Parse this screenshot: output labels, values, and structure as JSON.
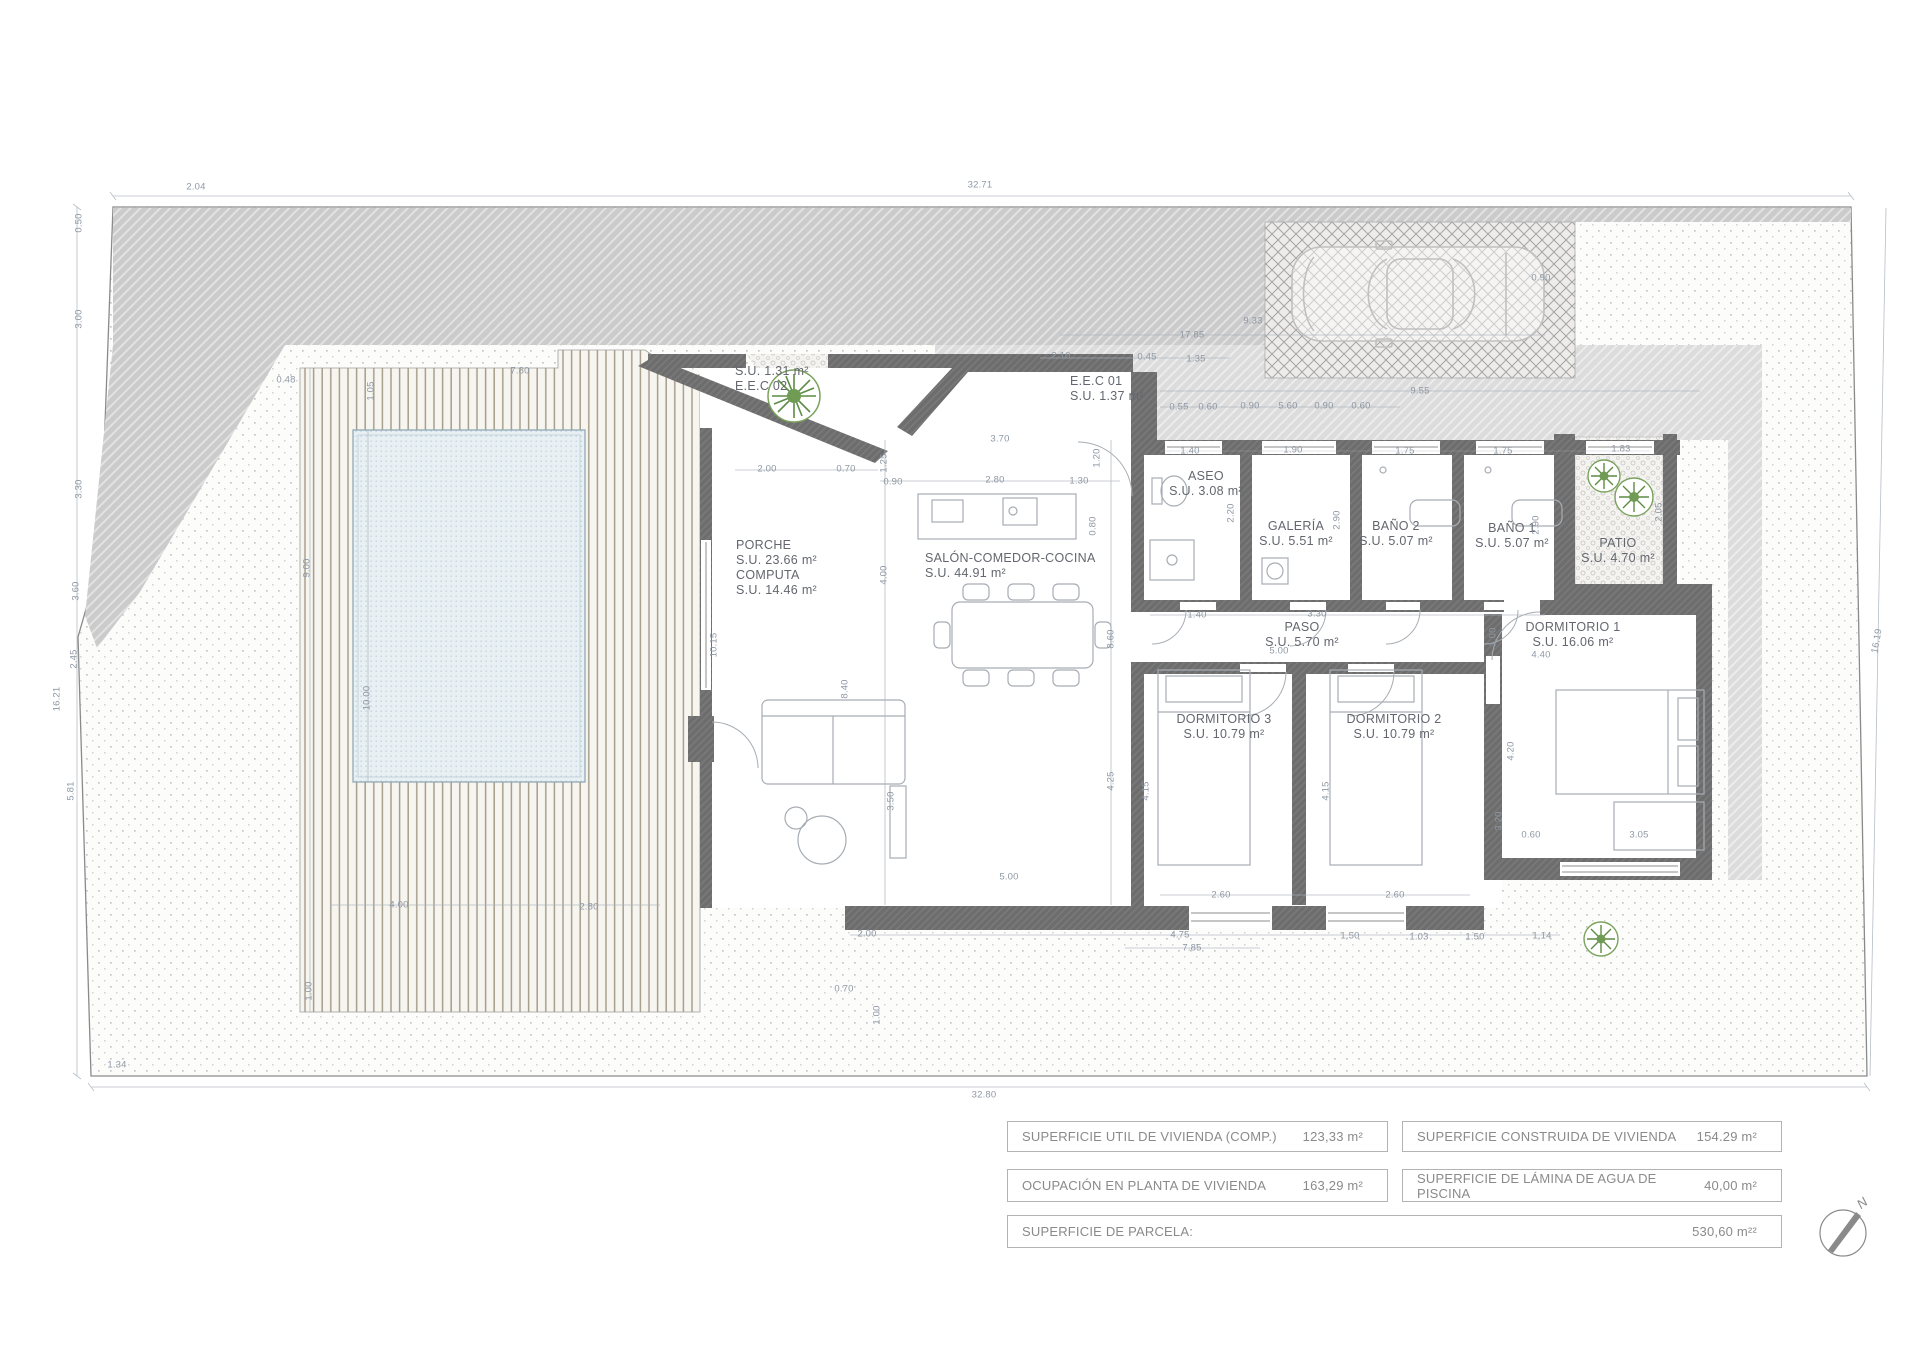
{
  "colors": {
    "wall_gray": "#6d6d6d",
    "pool_blue": "#e9f0f4",
    "plant_green": "#6f9b55",
    "dim_text": "#8e98a4",
    "hatch_gray": "#cbcbcb"
  },
  "compass": {
    "north": "N"
  },
  "plan": {
    "rooms": [
      {
        "l1": "PORCHE",
        "l2": "S.U. 23.66 m²",
        "x": 736,
        "y": 538,
        "a": "l"
      },
      {
        "l1": "COMPUTA",
        "l2": "S.U. 14.46 m²",
        "x": 736,
        "y": 568,
        "a": "l"
      },
      {
        "l1": "SALÓN-COMEDOR-COCINA",
        "l2": "S.U. 44.91 m²",
        "x": 925,
        "y": 551,
        "a": "l"
      },
      {
        "l1": "E.E.C 01",
        "l2": "S.U. 1.37 m²",
        "x": 1070,
        "y": 374,
        "a": "l"
      },
      {
        "l1": "S.U. 1.31 m²",
        "l2": "E.E.C 02",
        "x": 735,
        "y": 364,
        "a": "l"
      },
      {
        "l1": "ASEO",
        "l2": "S.U. 3.08 m²",
        "x": 1206,
        "y": 469,
        "a": "c"
      },
      {
        "l1": "GALERÍA",
        "l2": "S.U. 5.51 m²",
        "x": 1296,
        "y": 519,
        "a": "c"
      },
      {
        "l1": "BAÑO 2",
        "l2": "S.U. 5.07 m²",
        "x": 1396,
        "y": 519,
        "a": "c"
      },
      {
        "l1": "BAÑO 1",
        "l2": "S.U. 5.07 m²",
        "x": 1512,
        "y": 521,
        "a": "c"
      },
      {
        "l1": "PATIO",
        "l2": "S.U. 4.70 m²",
        "x": 1618,
        "y": 536,
        "a": "c"
      },
      {
        "l1": "PASO",
        "l2": "S.U. 5.70 m²",
        "x": 1302,
        "y": 620,
        "a": "c"
      },
      {
        "l1": "DORMITORIO 1",
        "l2": "S.U. 16.06 m²",
        "x": 1573,
        "y": 620,
        "a": "c"
      },
      {
        "l1": "DORMITORIO 3",
        "l2": "S.U. 10.79 m²",
        "x": 1224,
        "y": 712,
        "a": "c"
      },
      {
        "l1": "DORMITORIO 2",
        "l2": "S.U. 10.79 m²",
        "x": 1394,
        "y": 712,
        "a": "c"
      }
    ],
    "dims": [
      [
        "32.71",
        980,
        185,
        0
      ],
      [
        "2.04",
        196,
        187,
        0
      ],
      [
        "0.90",
        1541,
        278,
        0
      ],
      [
        "9.33",
        1253,
        321,
        0
      ],
      [
        "17.85",
        1192,
        335,
        0
      ],
      [
        "2.10",
        1061,
        356,
        0
      ],
      [
        "0.45",
        1147,
        357,
        0
      ],
      [
        "1.35",
        1196,
        359,
        0
      ],
      [
        "9.55",
        1420,
        391,
        0
      ],
      [
        "0.55",
        1179,
        407,
        0
      ],
      [
        "0.60",
        1208,
        407,
        0
      ],
      [
        "0.90",
        1250,
        406,
        0
      ],
      [
        "5.60",
        1288,
        406,
        0
      ],
      [
        "0.90",
        1324,
        406,
        0
      ],
      [
        "0.60",
        1361,
        406,
        0
      ],
      [
        "7.80",
        520,
        371,
        0
      ],
      [
        "0.48",
        286,
        380,
        0
      ],
      [
        "1.05",
        371,
        391,
        -90
      ],
      [
        "9.00",
        307,
        568,
        -90
      ],
      [
        "10.00",
        367,
        698,
        -90
      ],
      [
        "2.00",
        767,
        469,
        0
      ],
      [
        "0.70",
        846,
        469,
        0
      ],
      [
        "3.70",
        1000,
        439,
        0
      ],
      [
        "1.25",
        884,
        463,
        -90
      ],
      [
        "0.90",
        893,
        482,
        0
      ],
      [
        "2.80",
        995,
        480,
        0
      ],
      [
        "1.30",
        1079,
        481,
        0
      ],
      [
        "1.20",
        1097,
        458,
        -90
      ],
      [
        "0.80",
        1093,
        526,
        -90
      ],
      [
        "4.00",
        884,
        575,
        -90
      ],
      [
        "10.15",
        714,
        645,
        -90
      ],
      [
        "8.40",
        845,
        689,
        -90
      ],
      [
        "8.60",
        1111,
        639,
        -90
      ],
      [
        "3.50",
        891,
        801,
        -90
      ],
      [
        "4.25",
        1111,
        781,
        -90
      ],
      [
        "1.40",
        1190,
        451,
        0
      ],
      [
        "1.90",
        1293,
        450,
        0
      ],
      [
        "1.75",
        1405,
        451,
        0
      ],
      [
        "1.75",
        1503,
        451,
        0
      ],
      [
        "1.83",
        1621,
        449,
        0
      ],
      [
        "2.20",
        1231,
        513,
        -90
      ],
      [
        "2.90",
        1337,
        520,
        -90
      ],
      [
        "2.90",
        1536,
        525,
        -90
      ],
      [
        "2.05",
        1659,
        512,
        -90
      ],
      [
        "1.40",
        1197,
        615,
        0
      ],
      [
        "3.30",
        1317,
        614,
        0
      ],
      [
        "5.00",
        1279,
        651,
        0
      ],
      [
        "1.00",
        1493,
        637,
        -90
      ],
      [
        "4.40",
        1541,
        655,
        0
      ],
      [
        "4.15",
        1146,
        791,
        -90
      ],
      [
        "4.15",
        1326,
        791,
        -90
      ],
      [
        "4.20",
        1511,
        751,
        -90
      ],
      [
        "3.20",
        1499,
        821,
        -90
      ],
      [
        "0.60",
        1531,
        835,
        0
      ],
      [
        "3.05",
        1639,
        835,
        0
      ],
      [
        "2.60",
        1221,
        895,
        0
      ],
      [
        "2.60",
        1395,
        895,
        0
      ],
      [
        "5.00",
        1009,
        877,
        0
      ],
      [
        "4.00",
        399,
        905,
        0
      ],
      [
        "2.80",
        589,
        907,
        0
      ],
      [
        "2.00",
        867,
        934,
        0
      ],
      [
        "4.75",
        1180,
        935,
        0
      ],
      [
        "7.85",
        1192,
        948,
        0
      ],
      [
        "1.50",
        1350,
        936,
        0
      ],
      [
        "1.03",
        1419,
        937,
        0
      ],
      [
        "1.50",
        1475,
        937,
        0
      ],
      [
        "1.14",
        1542,
        936,
        0
      ],
      [
        "0.70",
        844,
        989,
        0
      ],
      [
        "1.00",
        877,
        1015,
        -90
      ],
      [
        "1.00",
        309,
        991,
        -90
      ],
      [
        "0.50",
        79,
        223,
        -90
      ],
      [
        "3.00",
        79,
        319,
        -90
      ],
      [
        "3.30",
        79,
        489,
        -90
      ],
      [
        "3.60",
        76,
        591,
        -90
      ],
      [
        "2.45",
        74,
        659,
        -90
      ],
      [
        "5.81",
        71,
        791,
        -90
      ],
      [
        "1.34",
        117,
        1065,
        0
      ],
      [
        "16.21",
        57,
        699,
        -90
      ],
      [
        "32.80",
        984,
        1095,
        0
      ],
      [
        "16.19",
        1877,
        641,
        -80
      ]
    ]
  },
  "table": {
    "rows": [
      {
        "label": "SUPERFICIE UTIL  DE VIVIENDA (COMP.)",
        "value": "123,33  m²"
      },
      {
        "label": "SUPERFICIE CONSTRUIDA DE VIVIENDA",
        "value": "154.29  m²"
      },
      {
        "label": "OCUPACIÓN EN PLANTA DE VIVIENDA",
        "value": "163,29 m²"
      },
      {
        "label": "SUPERFICIE DE LÁMINA DE AGUA DE PISCINA",
        "value": "40,00  m²"
      },
      {
        "label": "SUPERFICIE DE PARCELA:",
        "value": "530,60 m²²"
      }
    ]
  }
}
